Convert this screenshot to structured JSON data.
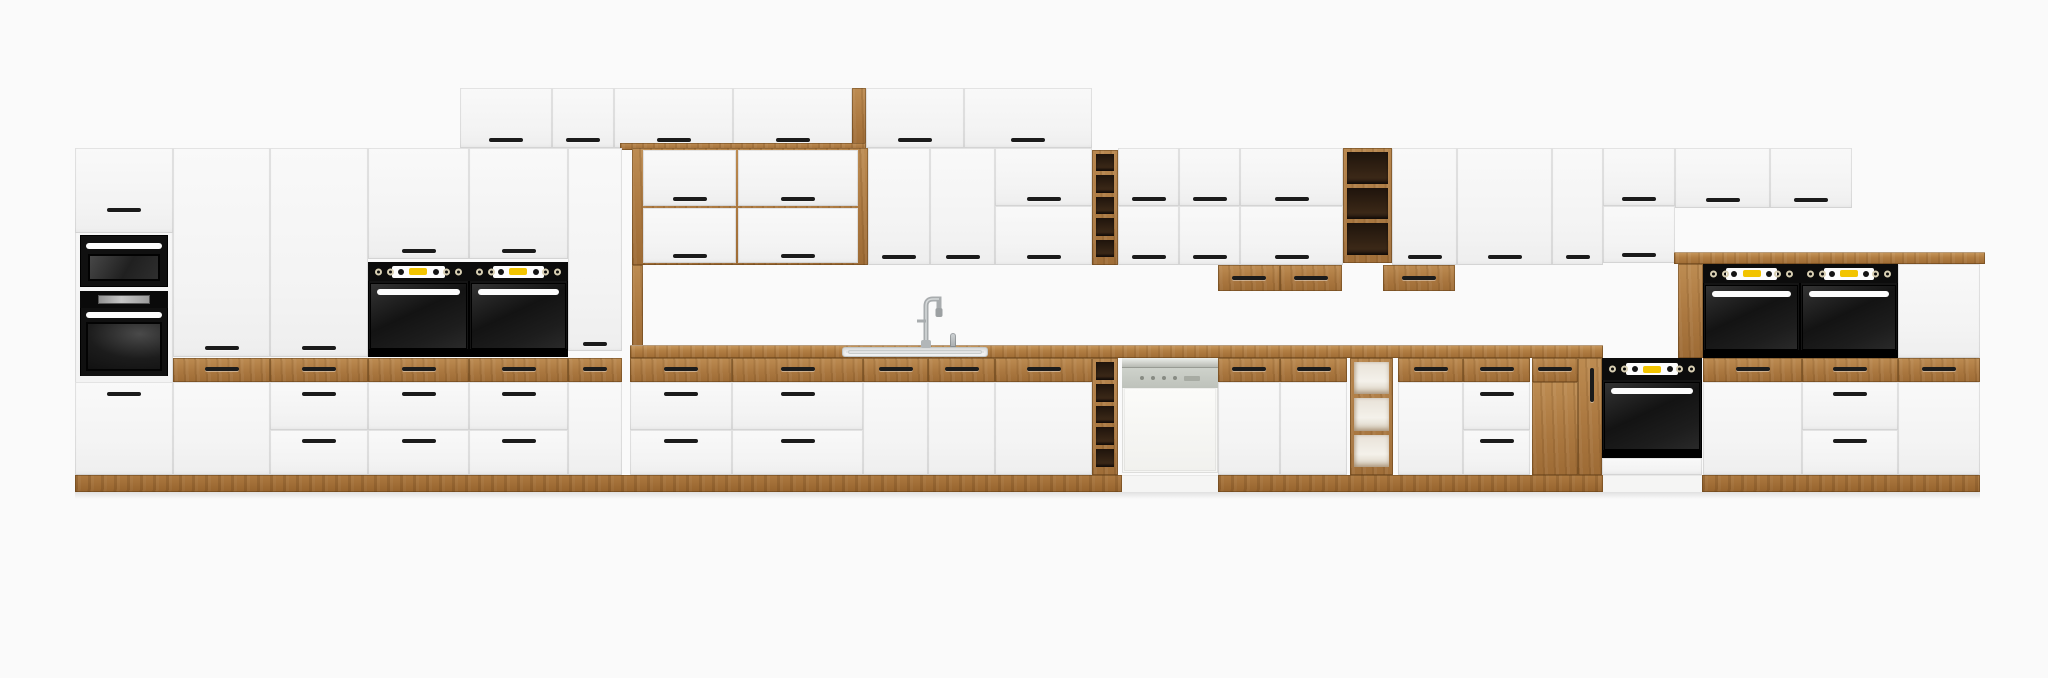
{
  "meta": {
    "description": "Product render of a long modular kitchen cabinet run: white matte fronts with oak (lancelot) accents, built-in black ovens, microwave, sink with tall faucet, semi-integrated dishwasher, open oak shelf and wine-rack modules",
    "visible_text": ""
  },
  "palette": {
    "background": "#fafafa",
    "front_white": "#f6f6f6",
    "oak": "#b5824a",
    "oak_dark": "#9d6b35",
    "appliance_black": "#141414",
    "display_yellow": "#f2c400",
    "steel_gray": "#c9cdc8",
    "handle_black": "#1b1b1b"
  },
  "scene": {
    "width": 2048,
    "height": 678
  },
  "modules": [
    {
      "n": "wall-top-door-1",
      "t": "door",
      "x": 460,
      "y": 88,
      "w": 92,
      "h": 60,
      "hd": [
        {
          "y": 140
        }
      ]
    },
    {
      "n": "wall-top-door-2",
      "t": "door",
      "x": 552,
      "y": 88,
      "w": 62,
      "h": 60,
      "hd": [
        {
          "y": 140
        }
      ]
    },
    {
      "n": "wall-top-door-3",
      "t": "door",
      "x": 614,
      "y": 88,
      "w": 119,
      "h": 60,
      "hd": [
        {
          "y": 140
        }
      ]
    },
    {
      "n": "wall-top-door-4",
      "t": "door",
      "x": 733,
      "y": 88,
      "w": 119,
      "h": 60,
      "hd": [
        {
          "y": 140
        }
      ]
    },
    {
      "n": "wall-top-oak-edge",
      "t": "oak",
      "x": 852,
      "y": 88,
      "w": 14,
      "h": 62
    },
    {
      "n": "wall-top-door-5",
      "t": "door",
      "x": 866,
      "y": 88,
      "w": 98,
      "h": 60,
      "hd": [
        {
          "y": 140
        }
      ]
    },
    {
      "n": "wall-top-door-6",
      "t": "door",
      "x": 964,
      "y": 88,
      "w": 128,
      "h": 60,
      "hd": [
        {
          "y": 140
        }
      ]
    },
    {
      "n": "wall-top-oak-lip",
      "t": "oak",
      "x": 620,
      "y": 143,
      "w": 246,
      "h": 7
    },
    {
      "n": "tall-left-column",
      "t": "door",
      "x": 75,
      "y": 148,
      "w": 98,
      "h": 327
    },
    {
      "n": "tall-left-top-door",
      "t": "door",
      "x": 75,
      "y": 148,
      "w": 98,
      "h": 85,
      "hd": [
        {
          "y": 210
        }
      ]
    },
    {
      "n": "microwave",
      "t": "micro",
      "x": 80,
      "y": 235,
      "w": 88,
      "h": 52
    },
    {
      "n": "oven-left-column",
      "t": "olcd",
      "x": 80,
      "y": 291,
      "w": 88,
      "h": 89
    },
    {
      "n": "tall-left-base-door",
      "t": "door",
      "x": 75,
      "y": 382,
      "w": 98,
      "h": 93,
      "hd": [
        {
          "y": 394
        }
      ]
    },
    {
      "n": "pantry-door-1",
      "t": "door",
      "x": 173,
      "y": 148,
      "w": 97,
      "h": 209,
      "hd": [
        {
          "y": 348
        }
      ]
    },
    {
      "n": "pantry-door-2",
      "t": "door",
      "x": 270,
      "y": 148,
      "w": 98,
      "h": 209,
      "hd": [
        {
          "y": 348
        }
      ]
    },
    {
      "n": "oven-column-door-1",
      "t": "door",
      "x": 368,
      "y": 148,
      "w": 101,
      "h": 111,
      "hd": [
        {
          "y": 251
        }
      ]
    },
    {
      "n": "oven-column-door-2",
      "t": "door",
      "x": 469,
      "y": 148,
      "w": 99,
      "h": 111,
      "hd": [
        {
          "y": 251
        }
      ]
    },
    {
      "n": "built-in-oven-1",
      "t": "oven",
      "x": 368,
      "y": 262,
      "w": 101,
      "h": 95
    },
    {
      "n": "built-in-oven-2",
      "t": "oven",
      "x": 469,
      "y": 262,
      "w": 99,
      "h": 95
    },
    {
      "n": "tall-door-narrow",
      "t": "door",
      "x": 568,
      "y": 148,
      "w": 54,
      "h": 203,
      "hd": [
        {
          "y": 344,
          "w": 24
        }
      ]
    },
    {
      "n": "hutch-oak-frame",
      "t": "oak",
      "x": 632,
      "y": 148,
      "w": 236,
      "h": 117
    },
    {
      "n": "hutch-flap-1",
      "t": "door",
      "x": 643,
      "y": 150,
      "w": 93,
      "h": 56,
      "hd": [
        {
          "y": 199
        }
      ]
    },
    {
      "n": "hutch-flap-2",
      "t": "door",
      "x": 738,
      "y": 150,
      "w": 120,
      "h": 56,
      "hd": [
        {
          "y": 199
        }
      ]
    },
    {
      "n": "hutch-flap-3",
      "t": "door",
      "x": 643,
      "y": 208,
      "w": 93,
      "h": 55,
      "hd": [
        {
          "y": 256
        }
      ]
    },
    {
      "n": "hutch-flap-4",
      "t": "door",
      "x": 738,
      "y": 208,
      "w": 120,
      "h": 55,
      "hd": [
        {
          "y": 256
        }
      ]
    },
    {
      "n": "hutch-side-stile",
      "t": "oak",
      "x": 632,
      "y": 265,
      "w": 11,
      "h": 87
    },
    {
      "n": "wall-door-a",
      "t": "door",
      "x": 868,
      "y": 148,
      "w": 62,
      "h": 117,
      "hd": [
        {
          "y": 257
        }
      ]
    },
    {
      "n": "wall-door-b",
      "t": "door",
      "x": 930,
      "y": 148,
      "w": 65,
      "h": 117,
      "hd": [
        {
          "y": 257
        }
      ]
    },
    {
      "n": "wall-flap-c1",
      "t": "door",
      "x": 995,
      "y": 148,
      "w": 97,
      "h": 58,
      "hd": [
        {
          "y": 199
        }
      ]
    },
    {
      "n": "wall-flap-c2",
      "t": "door",
      "x": 995,
      "y": 206,
      "w": 97,
      "h": 59,
      "hd": [
        {
          "y": 257
        }
      ]
    },
    {
      "n": "wine-rack-wall",
      "t": "shelf",
      "x": 1092,
      "y": 150,
      "w": 26,
      "h": 115,
      "c": 5
    },
    {
      "n": "wall-flap-d1",
      "t": "door",
      "x": 1118,
      "y": 148,
      "w": 61,
      "h": 58,
      "hd": [
        {
          "y": 199
        }
      ]
    },
    {
      "n": "wall-flap-d2",
      "t": "door",
      "x": 1118,
      "y": 206,
      "w": 61,
      "h": 59,
      "hd": [
        {
          "y": 257
        }
      ]
    },
    {
      "n": "wall-flap-e1",
      "t": "door",
      "x": 1179,
      "y": 148,
      "w": 61,
      "h": 58,
      "hd": [
        {
          "y": 199
        }
      ]
    },
    {
      "n": "wall-flap-e2",
      "t": "door",
      "x": 1179,
      "y": 206,
      "w": 61,
      "h": 59,
      "hd": [
        {
          "y": 257
        }
      ]
    },
    {
      "n": "wall-flap-f1",
      "t": "door",
      "x": 1240,
      "y": 148,
      "w": 103,
      "h": 58,
      "hd": [
        {
          "y": 199
        }
      ]
    },
    {
      "n": "wall-flap-f2",
      "t": "door",
      "x": 1240,
      "y": 206,
      "w": 103,
      "h": 59,
      "hd": [
        {
          "y": 257
        }
      ]
    },
    {
      "n": "open-shelf-wall",
      "t": "shelf",
      "x": 1343,
      "y": 148,
      "w": 49,
      "h": 115,
      "c": 3
    },
    {
      "n": "wall-door-g",
      "t": "door",
      "x": 1392,
      "y": 148,
      "w": 65,
      "h": 117,
      "hd": [
        {
          "y": 257
        }
      ]
    },
    {
      "n": "wall-door-h",
      "t": "door",
      "x": 1457,
      "y": 148,
      "w": 95,
      "h": 117,
      "hd": [
        {
          "y": 257
        }
      ]
    },
    {
      "n": "wall-door-i",
      "t": "door",
      "x": 1552,
      "y": 148,
      "w": 51,
      "h": 117,
      "hd": [
        {
          "y": 257,
          "w": 24
        }
      ]
    },
    {
      "n": "wall-flap-j1",
      "t": "door",
      "x": 1603,
      "y": 148,
      "w": 72,
      "h": 58,
      "hd": [
        {
          "y": 199
        }
      ]
    },
    {
      "n": "wall-flap-j2",
      "t": "door",
      "x": 1603,
      "y": 206,
      "w": 72,
      "h": 57,
      "hd": [
        {
          "y": 255
        }
      ]
    },
    {
      "n": "wall-door-k",
      "t": "door",
      "x": 1675,
      "y": 148,
      "w": 95,
      "h": 60,
      "hd": [
        {
          "y": 200
        }
      ]
    },
    {
      "n": "wall-door-l",
      "t": "door",
      "x": 1770,
      "y": 148,
      "w": 82,
      "h": 60,
      "hd": [
        {
          "y": 200
        }
      ]
    },
    {
      "n": "undercab-oak-drawer-1",
      "t": "oakdrawer",
      "x": 1218,
      "y": 265,
      "w": 62,
      "h": 26,
      "hd": [
        {
          "y": 278
        }
      ]
    },
    {
      "n": "undercab-oak-drawer-2",
      "t": "oakdrawer",
      "x": 1280,
      "y": 265,
      "w": 62,
      "h": 26,
      "hd": [
        {
          "y": 278
        }
      ]
    },
    {
      "n": "undercab-oak-drawer-3",
      "t": "oakdrawer",
      "x": 1383,
      "y": 265,
      "w": 72,
      "h": 26,
      "hd": [
        {
          "y": 278
        }
      ]
    },
    {
      "n": "worktop",
      "t": "worktop",
      "x": 630,
      "y": 345,
      "w": 973,
      "h": 13
    },
    {
      "n": "sink-basin",
      "t": "sink",
      "x": 842,
      "y": 347,
      "w": 146,
      "h": 10
    },
    {
      "n": "faucet",
      "t": "faucet",
      "x": 904,
      "y": 288,
      "w": 48,
      "h": 60
    },
    {
      "n": "soap-dispenser",
      "t": "nub",
      "x": 950,
      "y": 333,
      "w": 6,
      "h": 14
    },
    {
      "n": "sideboard-oak-top",
      "t": "worktop",
      "x": 1674,
      "y": 252,
      "w": 311,
      "h": 12
    },
    {
      "n": "sideboard-oak-stile",
      "t": "oak",
      "x": 1678,
      "y": 264,
      "w": 25,
      "h": 94
    },
    {
      "n": "built-in-oven-3",
      "t": "oven",
      "x": 1703,
      "y": 264,
      "w": 97,
      "h": 94
    },
    {
      "n": "built-in-oven-4",
      "t": "oven",
      "x": 1800,
      "y": 264,
      "w": 98,
      "h": 94
    },
    {
      "n": "sideboard-white-door",
      "t": "door",
      "x": 1898,
      "y": 264,
      "w": 82,
      "h": 94
    },
    {
      "n": "oak-drawer-173",
      "t": "oakdrawer",
      "x": 173,
      "y": 358,
      "w": 97,
      "h": 24,
      "hd": [
        {
          "y": 369
        }
      ]
    },
    {
      "n": "oak-drawer-270",
      "t": "oakdrawer",
      "x": 270,
      "y": 358,
      "w": 98,
      "h": 24,
      "hd": [
        {
          "y": 369
        }
      ]
    },
    {
      "n": "oak-drawer-368",
      "t": "oakdrawer",
      "x": 368,
      "y": 358,
      "w": 101,
      "h": 24,
      "hd": [
        {
          "y": 369
        }
      ]
    },
    {
      "n": "oak-drawer-469",
      "t": "oakdrawer",
      "x": 469,
      "y": 358,
      "w": 99,
      "h": 24,
      "hd": [
        {
          "y": 369
        }
      ]
    },
    {
      "n": "oak-drawer-568",
      "t": "oakdrawer",
      "x": 568,
      "y": 358,
      "w": 54,
      "h": 24,
      "hd": [
        {
          "y": 369,
          "w": 24
        }
      ]
    },
    {
      "n": "oak-drawer-630",
      "t": "oakdrawer",
      "x": 630,
      "y": 358,
      "w": 102,
      "h": 24,
      "hd": [
        {
          "y": 369
        }
      ]
    },
    {
      "n": "oak-drawer-732",
      "t": "oakdrawer",
      "x": 732,
      "y": 358,
      "w": 131,
      "h": 24,
      "hd": [
        {
          "y": 369
        }
      ]
    },
    {
      "n": "oak-drawer-863",
      "t": "oakdrawer",
      "x": 863,
      "y": 358,
      "w": 65,
      "h": 24,
      "hd": [
        {
          "y": 369
        }
      ]
    },
    {
      "n": "oak-drawer-928",
      "t": "oakdrawer",
      "x": 928,
      "y": 358,
      "w": 67,
      "h": 24,
      "hd": [
        {
          "y": 369
        }
      ]
    },
    {
      "n": "oak-drawer-995",
      "t": "oakdrawer",
      "x": 995,
      "y": 358,
      "w": 97,
      "h": 24,
      "hd": [
        {
          "y": 369
        }
      ]
    },
    {
      "n": "base-door-173",
      "t": "door",
      "x": 173,
      "y": 382,
      "w": 97,
      "h": 93
    },
    {
      "n": "base-drawer-270a",
      "t": "drawer",
      "x": 270,
      "y": 382,
      "w": 98,
      "h": 48,
      "hd": [
        {
          "y": 394
        }
      ]
    },
    {
      "n": "base-drawer-270b",
      "t": "drawer",
      "x": 270,
      "y": 430,
      "w": 98,
      "h": 45,
      "hd": [
        {
          "y": 441
        }
      ]
    },
    {
      "n": "base-drawer-368a",
      "t": "drawer",
      "x": 368,
      "y": 382,
      "w": 101,
      "h": 48,
      "hd": [
        {
          "y": 394
        }
      ]
    },
    {
      "n": "base-drawer-368b",
      "t": "drawer",
      "x": 368,
      "y": 430,
      "w": 101,
      "h": 45,
      "hd": [
        {
          "y": 441
        }
      ]
    },
    {
      "n": "base-drawer-469a",
      "t": "drawer",
      "x": 469,
      "y": 382,
      "w": 99,
      "h": 48,
      "hd": [
        {
          "y": 394
        }
      ]
    },
    {
      "n": "base-drawer-469b",
      "t": "drawer",
      "x": 469,
      "y": 430,
      "w": 99,
      "h": 45,
      "hd": [
        {
          "y": 441
        }
      ]
    },
    {
      "n": "base-door-568",
      "t": "door",
      "x": 568,
      "y": 382,
      "w": 54,
      "h": 93
    },
    {
      "n": "base-drawer-630a",
      "t": "drawer",
      "x": 630,
      "y": 382,
      "w": 102,
      "h": 48,
      "hd": [
        {
          "y": 394
        }
      ]
    },
    {
      "n": "base-drawer-630b",
      "t": "drawer",
      "x": 630,
      "y": 430,
      "w": 102,
      "h": 45,
      "hd": [
        {
          "y": 441
        }
      ]
    },
    {
      "n": "base-drawer-732a",
      "t": "drawer",
      "x": 732,
      "y": 382,
      "w": 131,
      "h": 48,
      "hd": [
        {
          "y": 394
        }
      ]
    },
    {
      "n": "base-drawer-732b",
      "t": "drawer",
      "x": 732,
      "y": 430,
      "w": 131,
      "h": 45,
      "hd": [
        {
          "y": 441
        }
      ]
    },
    {
      "n": "sink-base-door-1",
      "t": "door",
      "x": 863,
      "y": 382,
      "w": 65,
      "h": 93
    },
    {
      "n": "sink-base-door-2",
      "t": "door",
      "x": 928,
      "y": 382,
      "w": 67,
      "h": 93
    },
    {
      "n": "base-door-995",
      "t": "door",
      "x": 995,
      "y": 382,
      "w": 97,
      "h": 93
    },
    {
      "n": "wine-rack-base",
      "t": "shelf",
      "x": 1092,
      "y": 358,
      "w": 26,
      "h": 117,
      "c": 5
    },
    {
      "n": "dishwasher",
      "t": "dw",
      "x": 1122,
      "y": 358,
      "w": 96,
      "h": 115
    },
    {
      "n": "oak-drawer-1218",
      "t": "oakdrawer",
      "x": 1218,
      "y": 358,
      "w": 62,
      "h": 24,
      "hd": [
        {
          "y": 369
        }
      ]
    },
    {
      "n": "oak-drawer-1280",
      "t": "oakdrawer",
      "x": 1280,
      "y": 358,
      "w": 67,
      "h": 24,
      "hd": [
        {
          "y": 369
        }
      ]
    },
    {
      "n": "base-door-1218",
      "t": "door",
      "x": 1218,
      "y": 382,
      "w": 62,
      "h": 93
    },
    {
      "n": "base-door-1280",
      "t": "door",
      "x": 1280,
      "y": 382,
      "w": 67,
      "h": 93
    },
    {
      "n": "open-shelf-base",
      "t": "shelfl",
      "x": 1350,
      "y": 358,
      "w": 43,
      "h": 117,
      "c": 3
    },
    {
      "n": "oak-drawer-1398",
      "t": "oakdrawer",
      "x": 1398,
      "y": 358,
      "w": 65,
      "h": 24,
      "hd": [
        {
          "y": 369
        }
      ]
    },
    {
      "n": "base-door-1398",
      "t": "door",
      "x": 1398,
      "y": 382,
      "w": 65,
      "h": 93
    },
    {
      "n": "oak-drawer-1463",
      "t": "oakdrawer",
      "x": 1463,
      "y": 358,
      "w": 67,
      "h": 24,
      "hd": [
        {
          "y": 369
        }
      ]
    },
    {
      "n": "base-drawer-1463a",
      "t": "drawer",
      "x": 1463,
      "y": 382,
      "w": 67,
      "h": 48,
      "hd": [
        {
          "y": 394
        }
      ]
    },
    {
      "n": "base-drawer-1463b",
      "t": "drawer",
      "x": 1463,
      "y": 430,
      "w": 67,
      "h": 45,
      "hd": [
        {
          "y": 441
        }
      ]
    },
    {
      "n": "oak-drawer-1532",
      "t": "oakdrawer",
      "x": 1532,
      "y": 358,
      "w": 46,
      "h": 24,
      "hd": [
        {
          "y": 369
        }
      ]
    },
    {
      "n": "oak-base-door-1532",
      "t": "oakdoor",
      "x": 1532,
      "y": 382,
      "w": 46,
      "h": 93
    },
    {
      "n": "oak-base-door-1578",
      "t": "oakdoor",
      "x": 1578,
      "y": 358,
      "w": 24,
      "h": 117,
      "hd": [
        {
          "x": 1592,
          "y": 385,
          "v": 1
        }
      ]
    },
    {
      "n": "built-in-oven-base",
      "t": "oven",
      "x": 1602,
      "y": 358,
      "w": 100,
      "h": 100,
      "v": "base"
    },
    {
      "n": "oven-base-white-strip",
      "t": "door",
      "x": 1602,
      "y": 458,
      "w": 100,
      "h": 17
    },
    {
      "n": "oak-drawer-1703",
      "t": "oakdrawer",
      "x": 1703,
      "y": 358,
      "w": 99,
      "h": 24,
      "hd": [
        {
          "y": 369
        }
      ]
    },
    {
      "n": "oak-drawer-1802",
      "t": "oakdrawer",
      "x": 1802,
      "y": 358,
      "w": 96,
      "h": 24,
      "hd": [
        {
          "y": 369
        }
      ]
    },
    {
      "n": "oak-drawer-1898",
      "t": "oakdrawer",
      "x": 1898,
      "y": 358,
      "w": 82,
      "h": 24,
      "hd": [
        {
          "y": 369
        }
      ]
    },
    {
      "n": "base-door-1703",
      "t": "door",
      "x": 1703,
      "y": 382,
      "w": 99,
      "h": 93
    },
    {
      "n": "base-drawer-1802a",
      "t": "drawer",
      "x": 1802,
      "y": 382,
      "w": 96,
      "h": 48,
      "hd": [
        {
          "y": 394
        }
      ]
    },
    {
      "n": "base-drawer-1802b",
      "t": "drawer",
      "x": 1802,
      "y": 430,
      "w": 96,
      "h": 45,
      "hd": [
        {
          "y": 441
        }
      ]
    },
    {
      "n": "base-door-1898",
      "t": "door",
      "x": 1898,
      "y": 382,
      "w": 82,
      "h": 93
    },
    {
      "n": "plinth-left",
      "t": "plinth",
      "x": 75,
      "y": 475,
      "w": 1047,
      "h": 17
    },
    {
      "n": "plinth-dishwasher",
      "t": "whiteplinth",
      "x": 1122,
      "y": 475,
      "w": 96,
      "h": 17
    },
    {
      "n": "plinth-mid",
      "t": "plinth",
      "x": 1218,
      "y": 475,
      "w": 385,
      "h": 17
    },
    {
      "n": "plinth-oven",
      "t": "whiteplinth",
      "x": 1603,
      "y": 475,
      "w": 99,
      "h": 17
    },
    {
      "n": "plinth-right",
      "t": "plinth",
      "x": 1702,
      "y": 475,
      "w": 278,
      "h": 17
    },
    {
      "n": "floor-shadow",
      "t": "shadowline",
      "x": 75,
      "y": 492,
      "w": 1905,
      "h": 7
    }
  ]
}
